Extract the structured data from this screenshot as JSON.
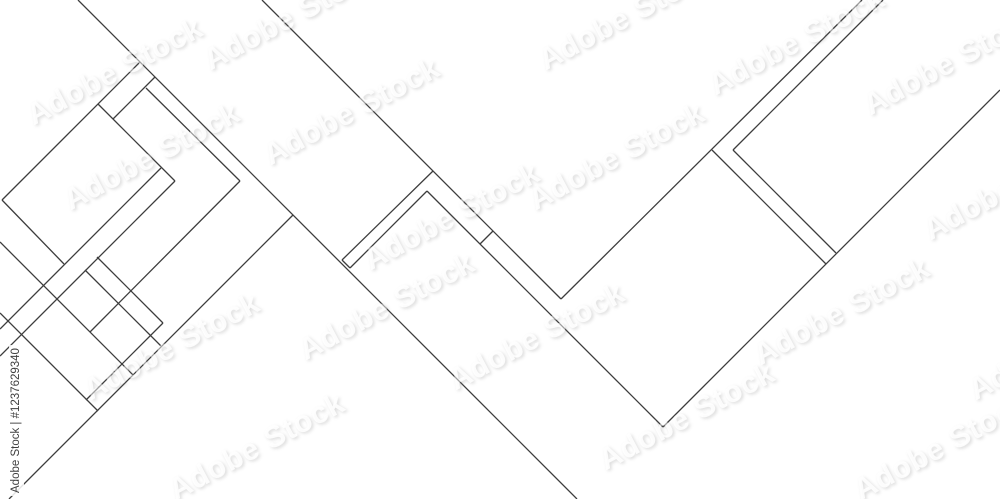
{
  "artwork": {
    "title": "abstract-geometric-line-background",
    "background": "#ffffff",
    "line": {
      "color": "#3d3d3d",
      "width": 1.3
    },
    "segments": [
      [
        78,
        0,
        577,
        499
      ],
      [
        146,
        88,
        240,
        181
      ],
      [
        240,
        181,
        90,
        332
      ],
      [
        140,
        62,
        2,
        200
      ],
      [
        2,
        200,
        64,
        264
      ],
      [
        98,
        104,
        175,
        181
      ],
      [
        113,
        119,
        155,
        77
      ],
      [
        175,
        181,
        0,
        356
      ],
      [
        161,
        168,
        0,
        329
      ],
      [
        9,
        499,
        293,
        215
      ],
      [
        0,
        242,
        133,
        375
      ],
      [
        0,
        313,
        98,
        411
      ],
      [
        97,
        257,
        163,
        323
      ],
      [
        163,
        323,
        86,
        400
      ],
      [
        85,
        270,
        161,
        346
      ],
      [
        262,
        0,
        561,
        299
      ],
      [
        862,
        0,
        561,
        299
      ],
      [
        433,
        171,
        342,
        260
      ],
      [
        342,
        260,
        350,
        268
      ],
      [
        350,
        268,
        427,
        191
      ],
      [
        427,
        191,
        663,
        427
      ],
      [
        663,
        427,
        1000,
        90
      ],
      [
        883,
        0,
        733,
        150
      ],
      [
        733,
        150,
        836,
        253
      ],
      [
        712,
        150,
        826,
        264
      ],
      [
        480,
        244,
        493,
        231
      ]
    ],
    "watermark": {
      "text": "Adobe Stock",
      "font_size": 30,
      "rotation": -28,
      "color": "rgba(255,255,255,0.9)",
      "shadow": "1px 2px 3px rgba(110,110,110,0.45)",
      "opacity": 0.55,
      "positions": [
        [
          18,
          55
        ],
        [
          195,
          0
        ],
        [
          255,
          95
        ],
        [
          55,
          140
        ],
        [
          160,
          430
        ],
        [
          75,
          330
        ],
        [
          355,
          200
        ],
        [
          520,
          140
        ],
        [
          530,
          0
        ],
        [
          700,
          25
        ],
        [
          745,
          295
        ],
        [
          590,
          400
        ],
        [
          855,
          45
        ],
        [
          915,
          170
        ],
        [
          845,
          430
        ],
        [
          440,
          320
        ],
        [
          290,
          290
        ],
        [
          960,
          330
        ]
      ]
    },
    "credit": {
      "text": "Adobe Stock | #1237629340",
      "color": "#3f3f3f",
      "font_size": 11.5
    }
  }
}
